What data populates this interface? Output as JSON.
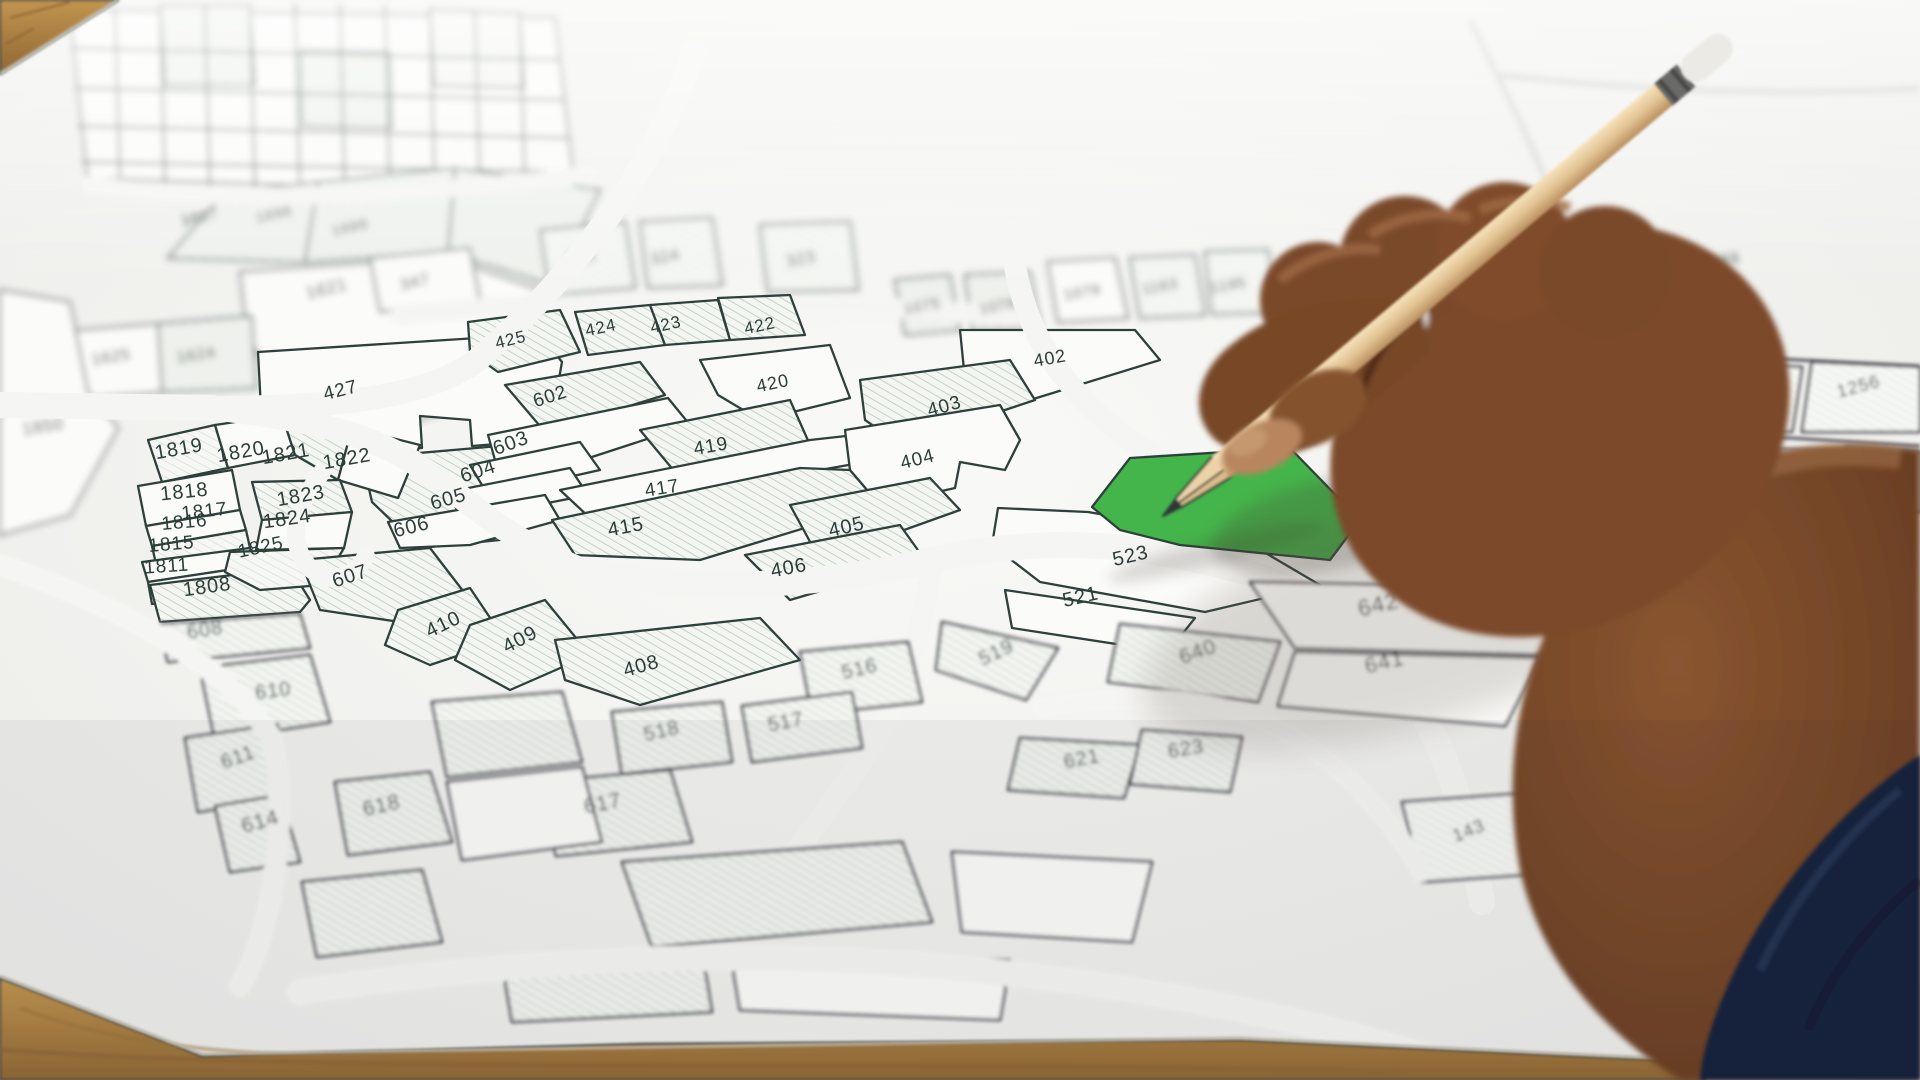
{
  "scene": {
    "description": "Photograph: a hand holding a wooden pencil points at a green highlighted land parcel numbered 524 on a cadastral plot map lying on a wooden table, with a navy sleeve in the lower right corner",
    "type": "photograph"
  },
  "map": {
    "kind": "cadastral-parcel-map",
    "highlighted_parcel": {
      "number": "524",
      "color": "#44b54a"
    },
    "label_color": "#2c3e3a",
    "line_color": "#2e403c",
    "paper_color": "#f5f5f3",
    "hatch_color": "#c5d1c8",
    "labels": [
      {
        "n": "1697",
        "x": 201,
        "y": 222,
        "r": -12,
        "s": 15,
        "z": "far"
      },
      {
        "n": "1698",
        "x": 275,
        "y": 219,
        "r": -12,
        "s": 15,
        "z": "far"
      },
      {
        "n": "1699",
        "x": 351,
        "y": 232,
        "r": -12,
        "s": 15,
        "z": "far"
      },
      {
        "n": "1621",
        "x": 328,
        "y": 294,
        "r": -14,
        "s": 17,
        "z": "far"
      },
      {
        "n": "1625",
        "x": 112,
        "y": 362,
        "r": -8,
        "s": 16,
        "z": "far"
      },
      {
        "n": "1624",
        "x": 197,
        "y": 360,
        "r": -8,
        "s": 16,
        "z": "far"
      },
      {
        "n": "1850",
        "x": 44,
        "y": 432,
        "r": -8,
        "s": 17,
        "z": "far"
      },
      {
        "n": "347",
        "x": 416,
        "y": 287,
        "r": -12,
        "s": 16,
        "z": "far"
      },
      {
        "n": "385",
        "x": 582,
        "y": 262,
        "r": -10,
        "s": 16,
        "z": "far"
      },
      {
        "n": "324",
        "x": 666,
        "y": 262,
        "r": -10,
        "s": 16,
        "z": "far"
      },
      {
        "n": "323",
        "x": 802,
        "y": 264,
        "r": -10,
        "s": 16,
        "z": "far"
      },
      {
        "n": "1075",
        "x": 923,
        "y": 311,
        "r": -10,
        "s": 15,
        "z": "far"
      },
      {
        "n": "1078",
        "x": 999,
        "y": 311,
        "r": -10,
        "s": 15,
        "z": "far"
      },
      {
        "n": "1079",
        "x": 1083,
        "y": 297,
        "r": -10,
        "s": 15,
        "z": "far"
      },
      {
        "n": "1163",
        "x": 1161,
        "y": 291,
        "r": -10,
        "s": 15,
        "z": "far"
      },
      {
        "n": "1195",
        "x": 1229,
        "y": 290,
        "r": -10,
        "s": 15,
        "z": "far"
      },
      {
        "n": "1163",
        "x": 1722,
        "y": 265,
        "r": -8,
        "s": 15,
        "z": "far"
      },
      {
        "n": "427",
        "x": 342,
        "y": 396,
        "r": -14,
        "s": 19,
        "z": "mid"
      },
      {
        "n": "1819",
        "x": 180,
        "y": 455,
        "r": -10,
        "s": 20,
        "z": "mid"
      },
      {
        "n": "1820",
        "x": 242,
        "y": 458,
        "r": -10,
        "s": 20,
        "z": "mid"
      },
      {
        "n": "1821",
        "x": 287,
        "y": 460,
        "r": -10,
        "s": 20,
        "z": "mid"
      },
      {
        "n": "1822",
        "x": 348,
        "y": 465,
        "r": -10,
        "s": 20,
        "z": "mid"
      },
      {
        "n": "1818",
        "x": 185,
        "y": 498,
        "r": -6,
        "s": 20,
        "z": "mid"
      },
      {
        "n": "1817",
        "x": 205,
        "y": 517,
        "r": -6,
        "s": 19,
        "z": "mid"
      },
      {
        "n": "1816",
        "x": 185,
        "y": 528,
        "r": -5,
        "s": 19,
        "z": "mid"
      },
      {
        "n": "1815",
        "x": 172,
        "y": 550,
        "r": -5,
        "s": 19,
        "z": "mid"
      },
      {
        "n": "1811",
        "x": 167,
        "y": 572,
        "r": -4,
        "s": 19,
        "z": "mid"
      },
      {
        "n": "1808",
        "x": 208,
        "y": 593,
        "r": -8,
        "s": 20,
        "z": "mid"
      },
      {
        "n": "1823",
        "x": 302,
        "y": 502,
        "r": -10,
        "s": 20,
        "z": "mid"
      },
      {
        "n": "1824",
        "x": 288,
        "y": 525,
        "r": -8,
        "s": 20,
        "z": "mid"
      },
      {
        "n": "1825",
        "x": 262,
        "y": 553,
        "r": -12,
        "s": 19,
        "z": "mid"
      },
      {
        "n": "602",
        "x": 552,
        "y": 402,
        "r": -18,
        "s": 19,
        "z": "mid"
      },
      {
        "n": "603",
        "x": 513,
        "y": 449,
        "r": -20,
        "s": 20,
        "z": "mid"
      },
      {
        "n": "604",
        "x": 480,
        "y": 477,
        "r": -18,
        "s": 20,
        "z": "mid"
      },
      {
        "n": "605",
        "x": 450,
        "y": 505,
        "r": -16,
        "s": 20,
        "z": "mid"
      },
      {
        "n": "606",
        "x": 413,
        "y": 533,
        "r": -14,
        "s": 20,
        "z": "mid"
      },
      {
        "n": "607",
        "x": 352,
        "y": 582,
        "r": -18,
        "s": 20,
        "z": "mid"
      },
      {
        "n": "425",
        "x": 512,
        "y": 345,
        "r": -14,
        "s": 17,
        "z": "mid"
      },
      {
        "n": "424",
        "x": 602,
        "y": 333,
        "r": -12,
        "s": 17,
        "z": "mid"
      },
      {
        "n": "423",
        "x": 667,
        "y": 330,
        "r": -12,
        "s": 17,
        "z": "mid"
      },
      {
        "n": "422",
        "x": 761,
        "y": 331,
        "r": -12,
        "s": 17,
        "z": "mid"
      },
      {
        "n": "420",
        "x": 774,
        "y": 389,
        "r": -12,
        "s": 18,
        "z": "mid"
      },
      {
        "n": "419",
        "x": 712,
        "y": 452,
        "r": -10,
        "s": 19,
        "z": "mid"
      },
      {
        "n": "417",
        "x": 663,
        "y": 494,
        "r": -9,
        "s": 19,
        "z": "mid"
      },
      {
        "n": "415",
        "x": 627,
        "y": 533,
        "r": -11,
        "s": 20,
        "z": "mid"
      },
      {
        "n": "402",
        "x": 1051,
        "y": 364,
        "r": -10,
        "s": 18,
        "z": "mid"
      },
      {
        "n": "403",
        "x": 946,
        "y": 412,
        "r": -16,
        "s": 19,
        "z": "mid"
      },
      {
        "n": "404",
        "x": 919,
        "y": 465,
        "r": -14,
        "s": 19,
        "z": "mid"
      },
      {
        "n": "405",
        "x": 848,
        "y": 533,
        "r": -13,
        "s": 20,
        "z": "mid"
      },
      {
        "n": "406",
        "x": 790,
        "y": 574,
        "r": -11,
        "s": 20,
        "z": "mid"
      },
      {
        "n": "410",
        "x": 446,
        "y": 630,
        "r": -26,
        "s": 20,
        "z": "mid"
      },
      {
        "n": "409",
        "x": 523,
        "y": 645,
        "r": -28,
        "s": 20,
        "z": "mid"
      },
      {
        "n": "408",
        "x": 643,
        "y": 672,
        "r": -16,
        "s": 20,
        "z": "mid"
      },
      {
        "n": "524",
        "x": 1216,
        "y": 489,
        "r": -9,
        "s": 19,
        "z": "mid",
        "c": "#1e3c26"
      },
      {
        "n": "523",
        "x": 1132,
        "y": 562,
        "r": -13,
        "s": 20,
        "z": "mid"
      },
      {
        "n": "521",
        "x": 1082,
        "y": 603,
        "r": -13,
        "s": 20,
        "z": "mid"
      },
      {
        "n": "608",
        "x": 206,
        "y": 636,
        "r": -9,
        "s": 20,
        "z": "near"
      },
      {
        "n": "610",
        "x": 274,
        "y": 697,
        "r": -7,
        "s": 20,
        "z": "near"
      },
      {
        "n": "611",
        "x": 240,
        "y": 763,
        "r": -20,
        "s": 20,
        "z": "near"
      },
      {
        "n": "614",
        "x": 262,
        "y": 828,
        "r": -16,
        "s": 21,
        "z": "near"
      },
      {
        "n": "618",
        "x": 383,
        "y": 812,
        "r": -13,
        "s": 21,
        "z": "near"
      },
      {
        "n": "617",
        "x": 604,
        "y": 810,
        "r": -11,
        "s": 21,
        "z": "near"
      },
      {
        "n": "516",
        "x": 861,
        "y": 675,
        "r": -13,
        "s": 20,
        "z": "near"
      },
      {
        "n": "517",
        "x": 787,
        "y": 728,
        "r": -11,
        "s": 20,
        "z": "near"
      },
      {
        "n": "518",
        "x": 663,
        "y": 737,
        "r": -13,
        "s": 20,
        "z": "near"
      },
      {
        "n": "519",
        "x": 999,
        "y": 658,
        "r": -26,
        "s": 20,
        "z": "near"
      },
      {
        "n": "621",
        "x": 1083,
        "y": 765,
        "r": -11,
        "s": 20,
        "z": "near"
      },
      {
        "n": "623",
        "x": 1187,
        "y": 755,
        "r": -9,
        "s": 20,
        "z": "near"
      },
      {
        "n": "640",
        "x": 1200,
        "y": 658,
        "r": -19,
        "s": 21,
        "z": "near"
      },
      {
        "n": "641",
        "x": 1386,
        "y": 669,
        "r": -13,
        "s": 22,
        "z": "near"
      },
      {
        "n": "642",
        "x": 1380,
        "y": 612,
        "r": -13,
        "s": 23,
        "z": "near"
      },
      {
        "n": "1255",
        "x": 1748,
        "y": 395,
        "r": -15,
        "s": 18,
        "z": "near"
      },
      {
        "n": "1256",
        "x": 1860,
        "y": 392,
        "r": -15,
        "s": 18,
        "z": "near"
      },
      {
        "n": "803",
        "x": 1787,
        "y": 478,
        "r": -13,
        "s": 19,
        "z": "near"
      },
      {
        "n": "804",
        "x": 1880,
        "y": 472,
        "r": -13,
        "s": 19,
        "z": "near"
      },
      {
        "n": "1091",
        "x": 1668,
        "y": 798,
        "r": -55,
        "s": 20,
        "z": "near"
      },
      {
        "n": "143",
        "x": 1471,
        "y": 836,
        "r": -22,
        "s": 18,
        "z": "near"
      },
      {
        "n": "1046",
        "x": 1626,
        "y": 902,
        "r": -16,
        "s": 19,
        "z": "near"
      }
    ]
  },
  "objects": {
    "pencil": {
      "wood_color": "#e3c392",
      "tip_color": "#333230",
      "eraser_color": "#eceae4",
      "ferrule_color": "#6a6a68"
    },
    "hand": {
      "skin_color": "#7c4a2b",
      "skin_highlight": "#b8855e"
    },
    "sleeve": {
      "color": "#18243d"
    },
    "table": {
      "wood_color": "#b08548"
    }
  }
}
